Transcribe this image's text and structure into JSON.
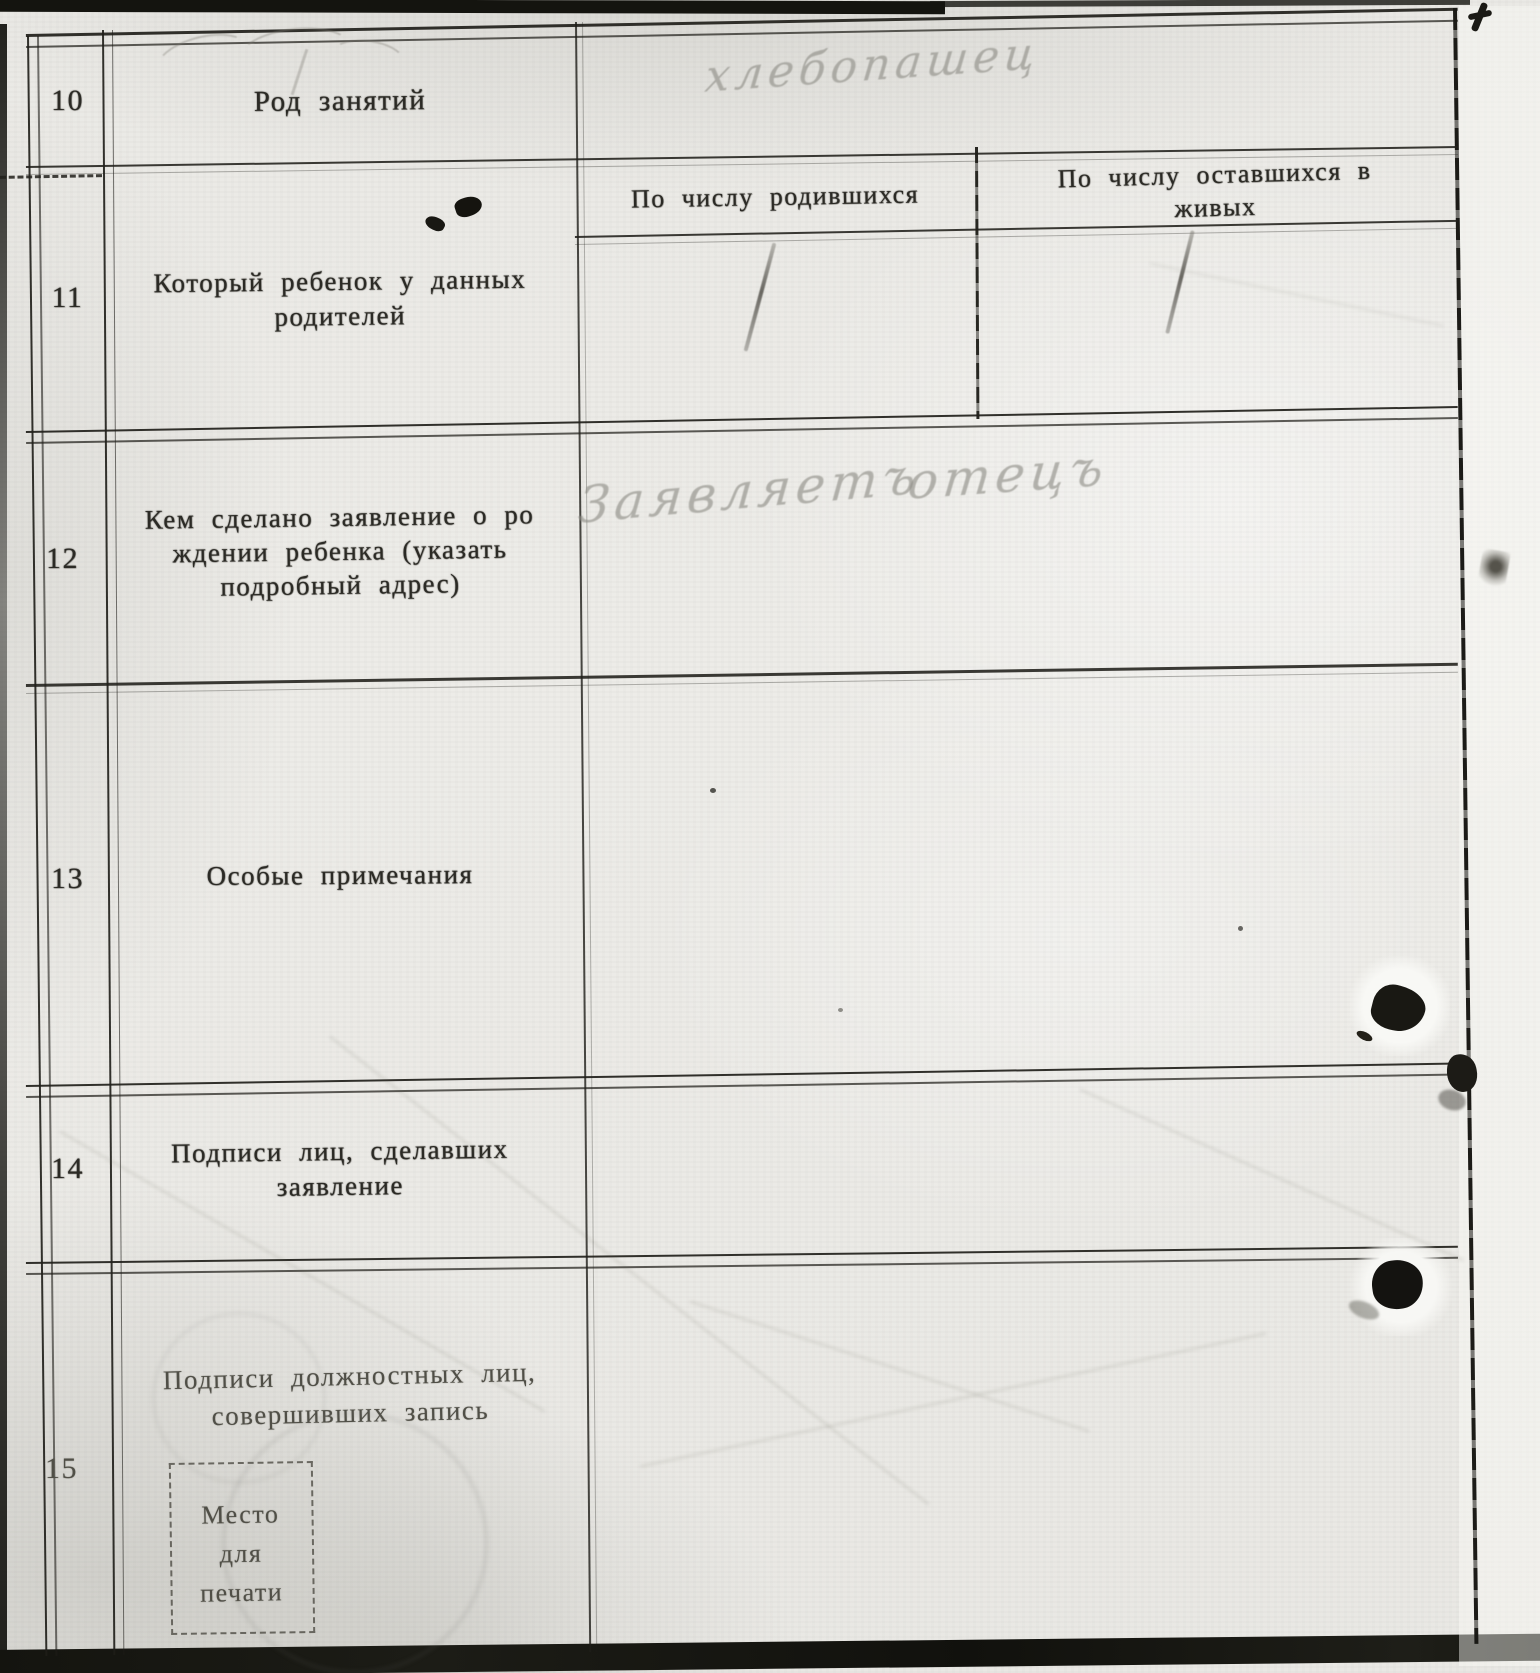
{
  "form": {
    "rows": [
      {
        "number": "10",
        "label_lines": [
          "Род занятий"
        ],
        "entry": {
          "handwritten": "хлебопашец"
        }
      },
      {
        "number": "11",
        "label_lines": [
          "Который ребенок у данных",
          "родителей"
        ],
        "sub_columns": [
          {
            "header_lines": [
              "По числу родившихся"
            ],
            "tally_value": "1"
          },
          {
            "header_lines": [
              "По числу оставшихся в",
              "живых"
            ],
            "tally_value": "1"
          }
        ]
      },
      {
        "number": "12",
        "label_lines": [
          "Кем сделано заявление о ро",
          "ждении ребенка (указать",
          "подробный адрес)"
        ],
        "entry": {
          "handwritten_words": [
            "Заявляетъ",
            "отецъ"
          ]
        }
      },
      {
        "number": "13",
        "label_lines": [
          "Особые примечания"
        ],
        "entry": {
          "handwritten": ""
        }
      },
      {
        "number": "14",
        "label_lines": [
          "Подписи лиц, сделавших",
          "заявление"
        ],
        "entry": {
          "handwritten": ""
        }
      },
      {
        "number": "15",
        "label_lines": [
          "Подписи должностных лиц,",
          "совершивших запись"
        ],
        "seal_box_lines": [
          "Место",
          "для",
          "печати"
        ],
        "entry": {
          "handwritten": ""
        }
      }
    ]
  },
  "colors": {
    "paper": "#ecebe7",
    "ink": "#2b2a25",
    "pencil": "#8d8c85",
    "line": "#24231f"
  }
}
